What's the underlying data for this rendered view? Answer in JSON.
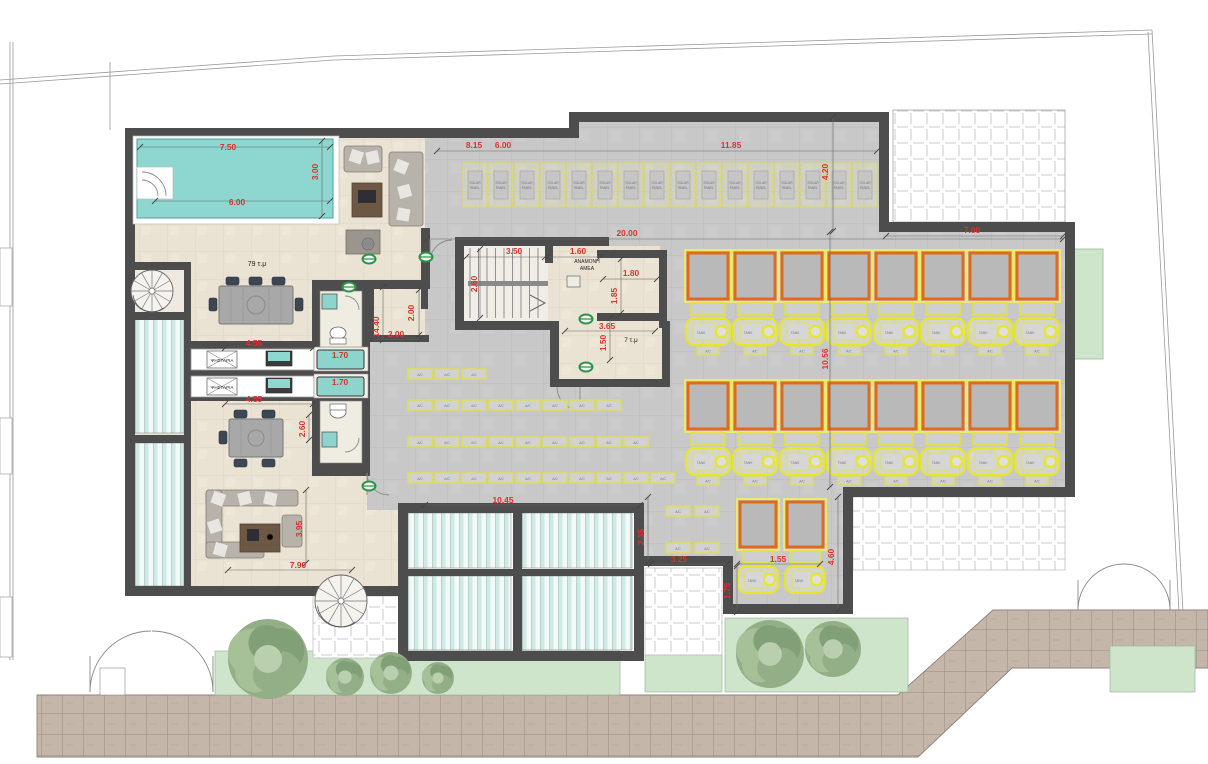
{
  "document": {
    "kind": "architectural floor plan",
    "units": "m"
  },
  "colors": {
    "dimension_red": "#d8342c",
    "wall_gray": "#4d4d4d",
    "pool_teal": "#8dd7d0",
    "solar_panel_orange": "#df6a1c",
    "equipment_yellow": "#e6e630",
    "planter_green": "#cfe5cb",
    "concrete_gray": "#c8c8c8",
    "pavement_tan": "#c4b7aa"
  },
  "labels": {
    "tank": "TANK",
    "ac": "A/C",
    "solar_line1": "SOLAR",
    "solar_line2": "PANEL"
  },
  "room_labels": [
    {
      "text": "79 τ.μ",
      "x": 257,
      "y": 266,
      "size": 7
    },
    {
      "text": "ΑΝΑΜΟΝΗ",
      "x": 587,
      "y": 263,
      "size": 5
    },
    {
      "text": "ΑΜΕΑ",
      "x": 587,
      "y": 270,
      "size": 5
    },
    {
      "text": "7 τ.μ",
      "x": 631,
      "y": 342,
      "size": 6.5
    },
    {
      "text": "ΨΗΣΤΑΡΙΑ",
      "x": 222,
      "y": 362,
      "size": 4.6
    },
    {
      "text": "ΨΗΣΤΑΡΙΑ",
      "x": 222,
      "y": 389,
      "size": 4.6
    }
  ],
  "dimensions": [
    {
      "text": "7.50",
      "x": 228,
      "y": 150
    },
    {
      "text": "3.00",
      "x": 318,
      "y": 172,
      "v": 1
    },
    {
      "text": "6.00",
      "x": 237,
      "y": 205
    },
    {
      "text": "8.15",
      "x": 474,
      "y": 148
    },
    {
      "text": "6.00",
      "x": 503,
      "y": 148
    },
    {
      "text": "11.85",
      "x": 731,
      "y": 148
    },
    {
      "text": "4.20",
      "x": 828,
      "y": 172,
      "v": 1
    },
    {
      "text": "20.00",
      "x": 627,
      "y": 236
    },
    {
      "text": "7.00",
      "x": 972,
      "y": 233
    },
    {
      "text": "3.50",
      "x": 514,
      "y": 254
    },
    {
      "text": "1.60",
      "x": 578,
      "y": 254
    },
    {
      "text": "2.60",
      "x": 477,
      "y": 284,
      "v": 1
    },
    {
      "text": "1.80",
      "x": 631,
      "y": 276
    },
    {
      "text": "1.85",
      "x": 617,
      "y": 296,
      "v": 1
    },
    {
      "text": "3.65",
      "x": 607,
      "y": 329
    },
    {
      "text": "1.50",
      "x": 606,
      "y": 343,
      "v": 1
    },
    {
      "text": "14.40",
      "x": 379,
      "y": 327,
      "v": 1
    },
    {
      "text": "2.00",
      "x": 414,
      "y": 313,
      "v": 1
    },
    {
      "text": "2.00",
      "x": 396,
      "y": 337
    },
    {
      "text": "4.55",
      "x": 254,
      "y": 346
    },
    {
      "text": "1.70",
      "x": 340,
      "y": 358
    },
    {
      "text": "1.70",
      "x": 340,
      "y": 385
    },
    {
      "text": "4.55",
      "x": 254,
      "y": 402
    },
    {
      "text": "2.60",
      "x": 305,
      "y": 429,
      "v": 1
    },
    {
      "text": "3.95",
      "x": 302,
      "y": 529,
      "v": 1
    },
    {
      "text": "7.90",
      "x": 298,
      "y": 568
    },
    {
      "text": "10.45",
      "x": 503,
      "y": 503
    },
    {
      "text": "2.35",
      "x": 644,
      "y": 537,
      "v": 1
    },
    {
      "text": "3.25",
      "x": 679,
      "y": 562
    },
    {
      "text": "1.55",
      "x": 778,
      "y": 562
    },
    {
      "text": "1.75",
      "x": 730,
      "y": 591,
      "v": 1
    },
    {
      "text": "4.60",
      "x": 834,
      "y": 557,
      "v": 1
    },
    {
      "text": "10.56",
      "x": 828,
      "y": 359,
      "v": 1
    }
  ],
  "solar_panel_row": {
    "count": 16,
    "x": 463,
    "y": 163,
    "pitch": 26,
    "w": 24,
    "h": 44
  },
  "solar_units": {
    "rows": [
      {
        "y": 253,
        "w": 40,
        "h": 46,
        "ac": true,
        "xs": [
          688,
          735,
          782,
          829,
          876,
          923,
          970,
          1017
        ]
      },
      {
        "y": 383,
        "w": 40,
        "h": 46,
        "ac": true,
        "xs": [
          688,
          735,
          782,
          829,
          876,
          923,
          970,
          1017
        ]
      },
      {
        "y": 502,
        "w": 36,
        "h": 45,
        "ac": false,
        "xs": [
          740,
          787
        ]
      }
    ]
  },
  "ac_rows": [
    {
      "y": 369,
      "x": 408,
      "count": 3,
      "pitch": 27
    },
    {
      "y": 400,
      "x": 408,
      "count": 8,
      "pitch": 27
    },
    {
      "y": 437,
      "x": 408,
      "count": 9,
      "pitch": 27
    },
    {
      "y": 473,
      "x": 408,
      "count": 10,
      "pitch": 27
    },
    {
      "y": 506,
      "x": 666,
      "count": 2,
      "pitch": 29
    },
    {
      "y": 543,
      "x": 666,
      "count": 2,
      "pitch": 29
    }
  ],
  "trees": [
    {
      "x": 268,
      "y": 659,
      "r": 40
    },
    {
      "x": 345,
      "y": 677,
      "r": 19
    },
    {
      "x": 391,
      "y": 673,
      "r": 21
    },
    {
      "x": 438,
      "y": 678,
      "r": 16
    },
    {
      "x": 770,
      "y": 654,
      "r": 34
    },
    {
      "x": 833,
      "y": 649,
      "r": 28
    }
  ],
  "green_ovals": [
    {
      "x": 369,
      "y": 259
    },
    {
      "x": 426,
      "y": 257
    },
    {
      "x": 349,
      "y": 287
    },
    {
      "x": 586,
      "y": 319
    },
    {
      "x": 586,
      "y": 367
    },
    {
      "x": 369,
      "y": 486
    }
  ]
}
